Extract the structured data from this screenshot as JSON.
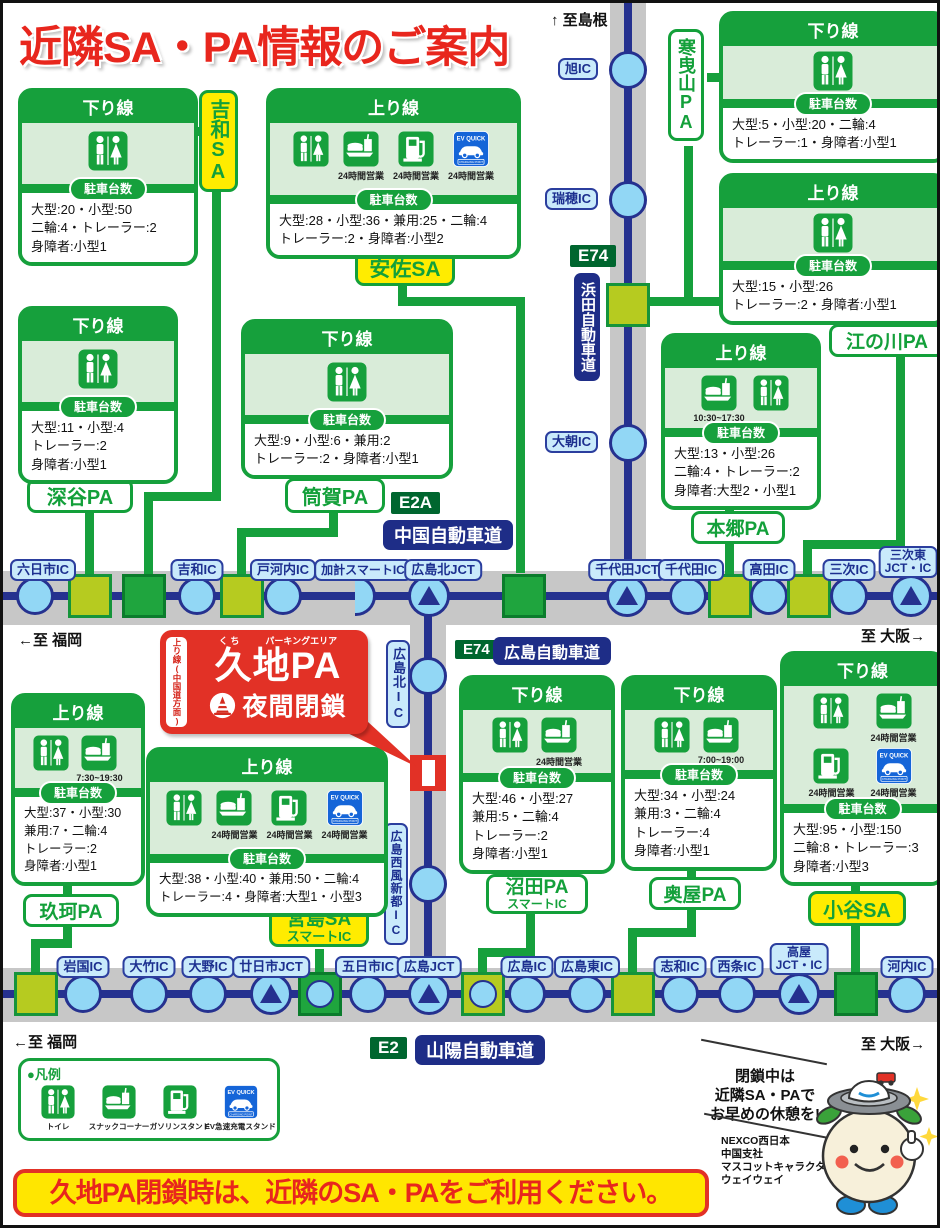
{
  "title": "近隣SA・PA情報のご案内",
  "directions": {
    "top": "↑ 至島根",
    "mid_left": "←至 福岡",
    "mid_right": "至 大阪→",
    "bottom_left": "←至 福岡",
    "bottom_right": "至 大阪→"
  },
  "highways": {
    "chugoku": {
      "badge": "E2A",
      "name": "中国自動車道"
    },
    "hiroshima": {
      "badge": "E74",
      "name": "広島自動車道"
    },
    "hamada": {
      "badge": "E74",
      "name": "浜田自動車道"
    },
    "sanyo": {
      "badge": "E2",
      "name": "山陽自動車道"
    }
  },
  "ic": {
    "rokunichi": "六日市IC",
    "yoshiwa": "吉和IC",
    "togouchi": "戸河内IC",
    "kake_smart": "加計スマートIC",
    "hiroshimakita_jct": "広島北JCT",
    "chiyoda_jct": "千代田JCT",
    "chiyoda": "千代田IC",
    "takata": "高田IC",
    "miyoshi": "三次IC",
    "miyoshi_higashi_1": "三次東",
    "miyoshi_higashi_2": "JCT・IC",
    "asahi": "旭IC",
    "mizuho": "瑞穂IC",
    "oasa": "大朝IC",
    "hiroshimakita": "広島北IC",
    "seifu_shinto": "広島西風新都IC",
    "iwakuni": "岩国IC",
    "otake": "大竹IC",
    "ono": "大野IC",
    "hatsukaichi_jct": "廿日市JCT",
    "itsukaichi": "五日市IC",
    "hiroshima_jct": "広島JCT",
    "hiroshima": "広島IC",
    "hiroshima_higashi": "広島東IC",
    "shiwa": "志和IC",
    "saijo": "西条IC",
    "takaya_1": "高屋",
    "takaya_2": "JCT・IC",
    "kochi": "河内IC"
  },
  "areas": {
    "yoshiwa_sa": "吉和SA",
    "asa_sa": "安佐SA",
    "kanbikiyama_pa": "寒曳山PA",
    "gonokawa_pa": "江の川PA",
    "fukaya_pa": "深谷PA",
    "tsutsuga_pa": "筒賀PA",
    "hongo_pa": "本郷PA",
    "kuga_pa": "玖珂PA",
    "miyajima_sa": "宮島SA",
    "miyajima_smart": "スマートIC",
    "numata_pa": "沼田PA",
    "numata_smart": "スマートIC",
    "okuya_pa": "奥屋PA",
    "kodani_sa": "小谷SA"
  },
  "labels": {
    "parking": "駐車台数"
  },
  "boxes": {
    "yoshiwa_down": {
      "heading": "下り線",
      "facilities": [
        {
          "icon": "toilet-icon",
          "time": ""
        }
      ],
      "lines": [
        "大型:20・小型:50",
        "二輪:4・トレーラー:2",
        "身障者:小型1"
      ]
    },
    "asa_up": {
      "heading": "上り線",
      "facilities": [
        {
          "icon": "toilet-icon",
          "time": ""
        },
        {
          "icon": "snack-icon",
          "time": "24時間営業"
        },
        {
          "icon": "gas-icon",
          "time": "24時間営業"
        },
        {
          "icon": "ev-icon",
          "time": "24時間営業"
        }
      ],
      "lines": [
        "大型:28・小型:36・兼用:25・二輪:4",
        "トレーラー:2・身障者:小型2"
      ]
    },
    "kanbikiyama_down": {
      "heading": "下り線",
      "facilities": [
        {
          "icon": "toilet-icon",
          "time": ""
        }
      ],
      "lines": [
        "大型:5・小型:20・二輪:4",
        "トレーラー:1・身障者:小型1"
      ]
    },
    "gonokawa_up": {
      "heading": "上り線",
      "facilities": [
        {
          "icon": "toilet-icon",
          "time": ""
        }
      ],
      "lines": [
        "大型:15・小型:26",
        "トレーラー:2・身障者:小型1"
      ]
    },
    "fukaya_down": {
      "heading": "下り線",
      "facilities": [
        {
          "icon": "toilet-icon",
          "time": ""
        }
      ],
      "lines": [
        "大型:11・小型:4",
        "トレーラー:2",
        "身障者:小型1"
      ]
    },
    "tsutsuga_down": {
      "heading": "下り線",
      "facilities": [
        {
          "icon": "toilet-icon",
          "time": ""
        }
      ],
      "lines": [
        "大型:9・小型:6・兼用:2",
        "トレーラー:2・身障者:小型1"
      ]
    },
    "hongo_up": {
      "heading": "上り線",
      "facilities": [
        {
          "icon": "snack-icon",
          "time": "10:30~17:30"
        },
        {
          "icon": "toilet-icon",
          "time": ""
        }
      ],
      "lines": [
        "大型:13・小型:26",
        "二輪:4・トレーラー:2",
        "身障者:大型2・小型1"
      ]
    },
    "kuga_up": {
      "heading": "上り線",
      "facilities": [
        {
          "icon": "toilet-icon",
          "time": ""
        },
        {
          "icon": "snack-icon",
          "time": "7:30~19:30"
        }
      ],
      "lines": [
        "大型:37・小型:30",
        "兼用:7・二輪:4",
        "トレーラー:2",
        "身障者:小型1"
      ]
    },
    "miyajima_up": {
      "heading": "上り線",
      "facilities": [
        {
          "icon": "toilet-icon",
          "time": ""
        },
        {
          "icon": "snack-icon",
          "time": "24時間営業"
        },
        {
          "icon": "gas-icon",
          "time": "24時間営業"
        },
        {
          "icon": "ev-icon",
          "time": "24時間営業"
        }
      ],
      "lines": [
        "大型:38・小型:40・兼用:50・二輪:4",
        "トレーラー:4・身障者:大型1・小型3"
      ]
    },
    "numata_down": {
      "heading": "下り線",
      "facilities": [
        {
          "icon": "toilet-icon",
          "time": ""
        },
        {
          "icon": "snack-icon",
          "time": "24時間営業"
        }
      ],
      "lines": [
        "大型:46・小型:27",
        "兼用:5・二輪:4",
        "トレーラー:2",
        "身障者:小型1"
      ]
    },
    "okuya_down": {
      "heading": "下り線",
      "facilities": [
        {
          "icon": "toilet-icon",
          "time": ""
        },
        {
          "icon": "snack-icon",
          "time": "7:00~19:00"
        }
      ],
      "lines": [
        "大型:34・小型:24",
        "兼用:3・二輪:4",
        "トレーラー:4",
        "身障者:小型1"
      ]
    },
    "kodani_down": {
      "heading": "下り線",
      "facilities": [
        {
          "icon": "toilet-icon",
          "time": ""
        },
        {
          "icon": "snack-icon",
          "time": "24時間営業"
        },
        {
          "icon": "gas-icon",
          "time": "24時間営業"
        },
        {
          "icon": "ev-icon",
          "time": "24時間営業"
        }
      ],
      "lines": [
        "大型:95・小型:150",
        "二輪:8・トレーラー:3",
        "身障者:小型3"
      ]
    }
  },
  "kuji": {
    "side": "上り線(中国道方面)",
    "furigana": "く ち",
    "kana": "パーキングエリア",
    "name": "久地PA",
    "closed": "夜間閉鎖"
  },
  "legend": {
    "title": "●凡例",
    "items": [
      {
        "icon": "toilet-icon",
        "label": "トイレ"
      },
      {
        "icon": "snack-icon",
        "label": "スナックコーナー"
      },
      {
        "icon": "gas-icon",
        "label": "ガソリンスタンド"
      },
      {
        "icon": "ev-icon",
        "label": "EV急速充電スタンド"
      }
    ]
  },
  "ev_badge": {
    "top": "EV QUICK",
    "bottom": "CHARGING POINT"
  },
  "notice": "久地PA閉鎖時は、近隣のSA・PAをご利用ください。",
  "mascot_note": {
    "line1": "閉鎖中は",
    "line2": "近隣SA・PAで",
    "line3": "お早めの休憩を!"
  },
  "credit": {
    "line1": "NEXCO西日本",
    "line2": "中国支社",
    "line3": "マスコットキャラクター",
    "line4": "ウェイウェイ"
  },
  "colors": {
    "green": "#16a03c",
    "yellow_green": "#b6cb20",
    "yellow": "#ffec00",
    "red": "#e23126",
    "navy": "#1e2d87",
    "light_blue": "#92d7f5",
    "road_gray": "#c7c7c7",
    "ev_blue": "#1565d8"
  }
}
